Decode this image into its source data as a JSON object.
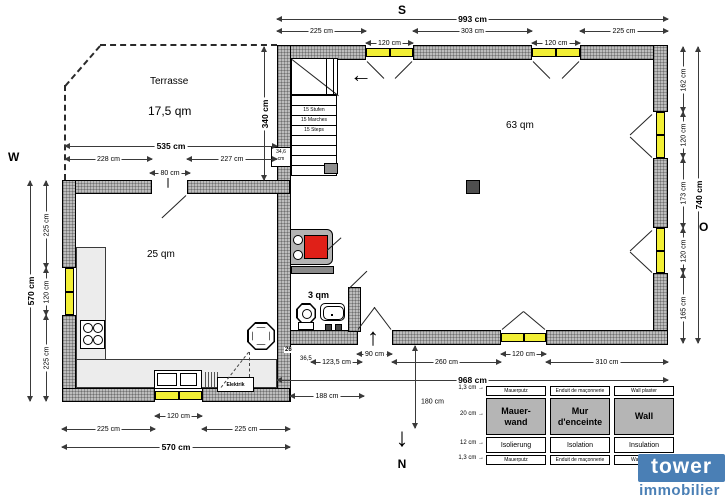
{
  "compass": {
    "south": "S",
    "west": "W",
    "east": "O",
    "north": "N"
  },
  "rooms": {
    "terrace": {
      "name": "Terrasse",
      "area": "17,5 qm"
    },
    "living": {
      "area": "63 qm"
    },
    "kitchen": {
      "area": "25 qm"
    },
    "wc": {
      "area": "3 qm"
    }
  },
  "stairs": {
    "labels": [
      "15 Stufen",
      "15 Marches",
      "15 Steps"
    ]
  },
  "dims": {
    "top_total": "993 cm",
    "top_left": "225 cm",
    "top_win1": "120 cm",
    "top_mid": "303 cm",
    "top_win2": "120 cm",
    "top_right": "225 cm",
    "right_1": "162 cm",
    "right_win1": "120 cm",
    "right_2": "173 cm",
    "right_win2": "120 cm",
    "right_3": "165 cm",
    "right_total": "740 cm",
    "left_1": "225 cm",
    "left_win": "120 cm",
    "left_2": "225 cm",
    "left_total": "570 cm",
    "terrace_total": "535 cm",
    "terrace_left": "228 cm",
    "terrace_door": "80 cm",
    "terrace_right": "227 cm",
    "terrace_depth": "340 cm",
    "bl_1": "225 cm",
    "bl_win": "120 cm",
    "bl_2": "225 cm",
    "bl_total": "570 cm",
    "b_26": "26",
    "b_365": "36,5",
    "b_1235": "123,5 cm",
    "b_door": "90 cm",
    "b_260": "260 cm",
    "b_win": "120 cm",
    "b_310": "310 cm",
    "b_total": "968 cm",
    "b_188": "188 cm",
    "b_180": "180 cm",
    "wall_thickness": "34,6\ncm"
  },
  "labels": {
    "elektrik": "Elektrik"
  },
  "legend": {
    "rows": [
      {
        "thickness": "1,3 cm",
        "de": "Mauerputz",
        "fr": "Enduit de maçonnerie",
        "en": "Wall plaster"
      },
      {
        "thickness": "20 cm",
        "de": "Mauer-\nwand",
        "fr": "Mur\nd'enceinte",
        "en": "Wall"
      },
      {
        "thickness": "12 cm",
        "de": "Isolierung",
        "fr": "Isolation",
        "en": "Insulation"
      },
      {
        "thickness": "1,3 cm",
        "de": "Mauerputz",
        "fr": "Enduit de maçonnerie",
        "en": "Wall plaster"
      }
    ]
  },
  "logo": {
    "brand": "tower",
    "sub": "immobilier"
  },
  "icons": {
    "up_arrow": "↑",
    "left_arrow": "←",
    "down_arrow": "↓",
    "right_arrow": "→"
  },
  "colors": {
    "wall_fill": "#bdbdbd",
    "window_yellow": "#f2ef35",
    "stove_red": "#e02018",
    "brand_blue": "#4a7fb5",
    "counter_gray": "#ececec"
  }
}
